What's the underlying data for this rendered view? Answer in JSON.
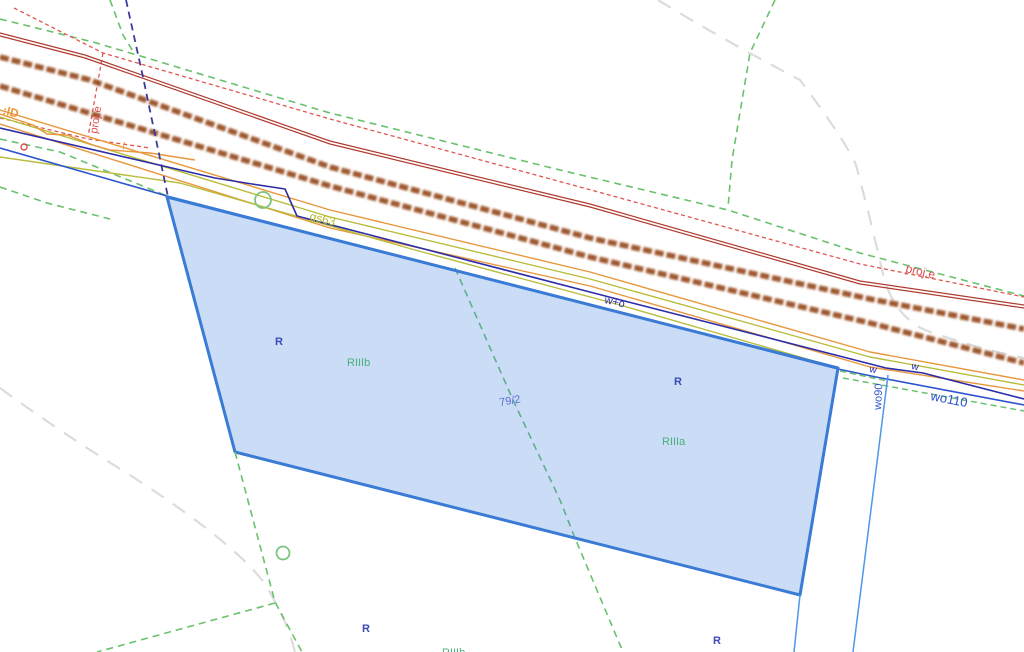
{
  "map": {
    "background": "#ffffff",
    "labels": {
      "ld": {
        "text": ":lD",
        "color": "#e8973d"
      },
      "proj_e_left": {
        "text": "proj.e",
        "color": "#d94f4f"
      },
      "l_mark": {
        "text": "l",
        "color": "#e8973d"
      },
      "gs63": {
        "text": "gs63",
        "color": "#b4b929"
      },
      "w_plus_o": {
        "text": "w+o",
        "color": "#2b2bb0"
      },
      "proj_e_right": {
        "text": "proj.e",
        "color": "#d94f4f"
      },
      "w_a": {
        "text": "w",
        "color": "#2b2bb0"
      },
      "w_b": {
        "text": "w",
        "color": "#2b2bb0"
      },
      "wo90": {
        "text": "wo90",
        "color": "#2d54cf"
      },
      "wo110": {
        "text": "wo110",
        "color": "#2d54cf"
      },
      "r_1": {
        "text": "R",
        "color": "#3a4ab8"
      },
      "riiib_1": {
        "text": "RIIIb",
        "color": "#4caf7d"
      },
      "p79_2": {
        "text": "79/2",
        "color": "#5b6fd6"
      },
      "r_2": {
        "text": "R",
        "color": "#3a4ab8"
      },
      "riiia": {
        "text": "RIIIa",
        "color": "#4caf7d"
      },
      "r_3": {
        "text": "R",
        "color": "#3a4ab8"
      },
      "riiib_2": {
        "text": "RIIIb",
        "color": "#4caf7d"
      },
      "r_4": {
        "text": "R",
        "color": "#3a4ab8"
      }
    },
    "colors": {
      "green_dashed_boundary": "#69c16d",
      "gray_dashed_terrain": "#dcdcdc",
      "red_dotted_projected": "#e0564f",
      "red_solid_line": "#b03a2e",
      "brown_road_edge": "#96491c",
      "orange_utility": "#e8973d",
      "olive_gas_line": "#b9bd3c",
      "navy_water_sewer": "#2d2da8",
      "blue_water_main": "#2d54cf",
      "corridor_blue": "#4f97e8",
      "navy_dashed_crossing": "#3a3a9e",
      "parcel_fill": "#3f83dd",
      "parcel_border": "#3a7bd5",
      "marker_green": "#7cc47f",
      "marker_red": "#d9534f"
    }
  }
}
